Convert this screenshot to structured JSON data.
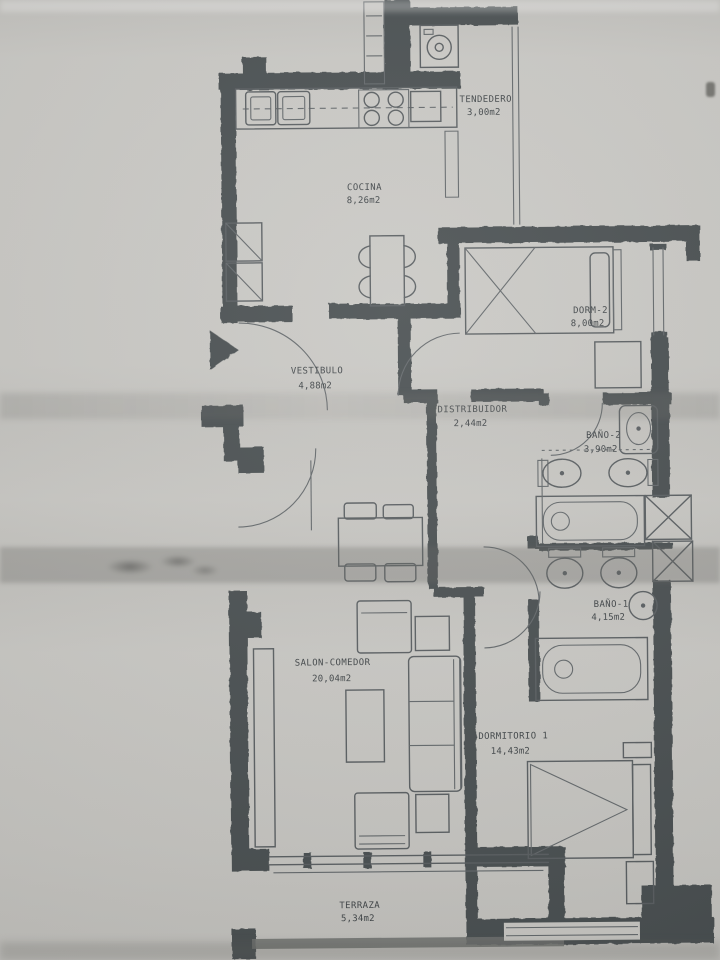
{
  "plan": {
    "rooms": [
      {
        "name": "TENDEDERO",
        "area": "3,00m2"
      },
      {
        "name": "COCINA",
        "area": "8,26m2"
      },
      {
        "name": "DORM-2",
        "area": "8,00m2"
      },
      {
        "name": "VESTIBULO",
        "area": "4,88m2"
      },
      {
        "name": "DISTRIBUIDOR",
        "area": "2,44m2"
      },
      {
        "name": "BAÑO-2",
        "area": "3,90m2"
      },
      {
        "name": "BAÑO-1",
        "area": "4,15m2"
      },
      {
        "name": "SALON-COMEDOR",
        "area": "20,04m2"
      },
      {
        "name": "DORMITORIO 1",
        "area": "14,43m2"
      },
      {
        "name": "TERRAZA",
        "area": "5,34m2"
      }
    ]
  },
  "colors": {
    "paper": "#c8c7c3",
    "wall": "#474d4f",
    "line": "#585d60",
    "text": "#3f4447"
  }
}
